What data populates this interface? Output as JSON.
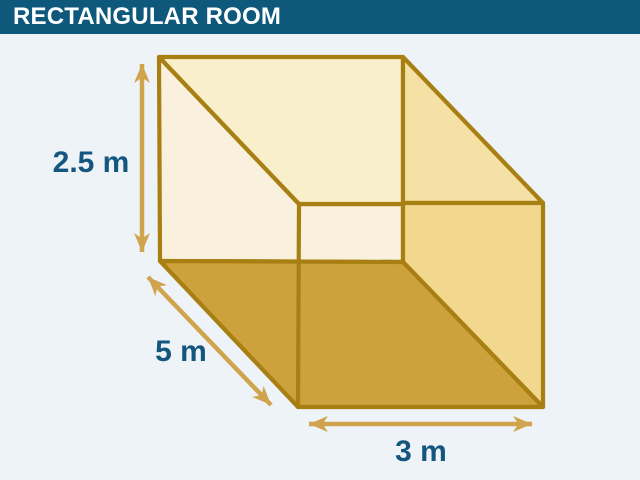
{
  "page": {
    "background": "#EEF3F8"
  },
  "header": {
    "title": "RECTANGULAR ROOM",
    "background": "#0E587C",
    "text_color": "#FFFFFF"
  },
  "diagram": {
    "type": "3d-room-cutaway",
    "dimensions": {
      "height_label": "2.5 m",
      "height_m": 2.5,
      "depth_label": "5 m",
      "depth_m": 5,
      "width_label": "3 m",
      "width_m": 3
    },
    "colors": {
      "walls": "#F9F0DE",
      "ceiling": "#FAEFCB",
      "ceiling_right": "#F5E0A5",
      "right_wall": "#F2D88E",
      "floor": "#CDA13C",
      "edge": "#A87F12",
      "arrow": "#CFA44C",
      "label_text": "#14567E"
    }
  }
}
